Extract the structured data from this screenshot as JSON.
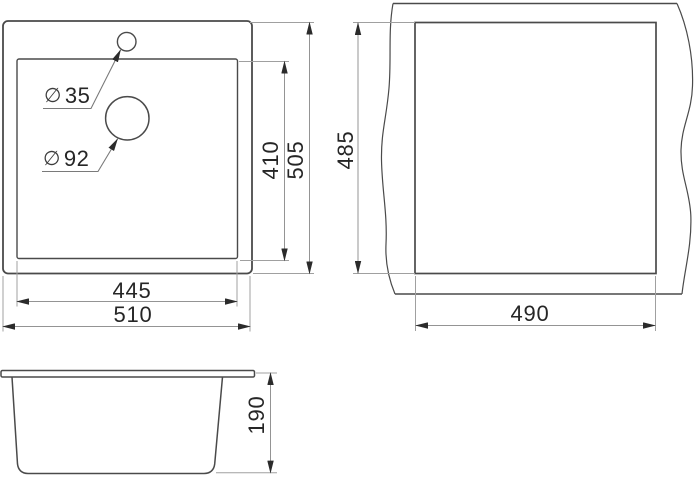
{
  "drawing_type": "sink technical dimension drawing",
  "colors": {
    "background": "#ffffff",
    "object_line": "#4a4a4a",
    "dimension_line": "#949494",
    "arrow": "#2b2b2b",
    "text": "#262626"
  },
  "top_view": {
    "name": "sink top view",
    "faucet_hole": {
      "symbol": "∅",
      "value": "35"
    },
    "drain_hole": {
      "symbol": "∅",
      "value": "92"
    },
    "dimensions": {
      "bowl_length": "445",
      "overall_length": "510",
      "bowl_width": "410",
      "overall_width": "505"
    }
  },
  "cutout_view": {
    "name": "countertop cutout view",
    "dimensions": {
      "cutout_height": "485",
      "cutout_width": "490"
    }
  },
  "side_view": {
    "name": "sink side view",
    "dimensions": {
      "height": "190"
    }
  }
}
